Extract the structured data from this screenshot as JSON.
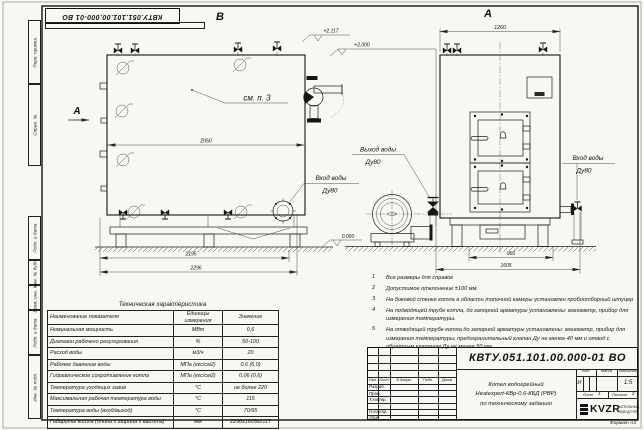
{
  "frame": {
    "stamp_top": "КВТУ.051.101.00.000-01 ВО",
    "format_note": "Формат  А3",
    "margin_top": [
      "Перв. примен.",
      "Справ. №"
    ],
    "margin_bottom": [
      "Подп. и дата",
      "Инв. № дубл.",
      "Взам. инв. №",
      "Подп. и дата",
      "Инв. № подл."
    ]
  },
  "views": {
    "view_b_label": "В",
    "view_a_label": "А",
    "section_a_label": "А",
    "callout_see_note": "см. п. 3",
    "dim_2050": "2050",
    "dim_2195": "2195",
    "dim_2296": "2296",
    "dim_1260": "1260",
    "dim_960": "960",
    "dim_1605": "1605",
    "elev_top": "+2.117",
    "elev_mid": "+2.000",
    "elev_zero": "0.000",
    "outlet_line1": "Выход воды",
    "outlet_line2": "Ду80",
    "inlet_b_line1": "Вход воды",
    "inlet_b_line2": "Ду80",
    "inlet_a_line1": "Вход воды",
    "inlet_a_line2": "Ду80"
  },
  "notes": {
    "items": [
      {
        "num": "1",
        "text": "Все размеры для справок"
      },
      {
        "num": "2",
        "text": "Допустимое отклонение ±100 мм."
      },
      {
        "num": "3",
        "text": "На боковой стенке котла в области топочной камеры установлен пробоотборный штуцер"
      },
      {
        "num": "4",
        "text": "На подводящей трубе котла, до запорной арматуры установлены: манометр, прибор для измерения температуры."
      },
      {
        "num": "5",
        "text": "На отводящей трубе котла до запорной арматуры установлены: манометр, прибор для измерения температуры, предохранительный клапан Ду не менее 40 мм и отвод с обратным клапаном Ду не менее 50 мм."
      }
    ]
  },
  "tech_table": {
    "title": "Техническая характеристика",
    "col_name": "Наименование показателя",
    "col_units": "Единицы измерения",
    "col_value": "Значение",
    "rows": [
      {
        "name": "Номинальная мощность",
        "units": "МВт",
        "value": "0,6"
      },
      {
        "name": "Диапазон рабочего регулирования",
        "units": "%",
        "value": "50-100"
      },
      {
        "name": "Расход воды",
        "units": "м3/ч",
        "value": "20"
      },
      {
        "name": "Рабочее давление воды",
        "units": "МПа (кгс/см2)",
        "value": "0,6 (6,0)"
      },
      {
        "name": "Гидравлическое сопротивление котла",
        "units": "МПа (кгс/см2)",
        "value": "0,06 (0,6)"
      },
      {
        "name": "Температура уходящих газов",
        "units": "°С",
        "value": "не более 220"
      },
      {
        "name": "Максимальная рабочая температура воды",
        "units": "°С",
        "value": "115"
      },
      {
        "name": "Температура воды (вход/выход)",
        "units": "°С",
        "value": "70/95"
      },
      {
        "name": "Габариты котла (длина х ширина х высота)",
        "units": "мм",
        "value": "2296х1605х2117"
      }
    ]
  },
  "title_block": {
    "doc_number": "КВТУ.051.101.00.000-01  ВО",
    "desc_line1": "Котел водогрейный",
    "desc_line2": "Heatexpert-КВр-0,6-КБД (РВР)",
    "desc_line3": "по техническому заданию",
    "col_izm": "Изм.",
    "col_list": "Лист",
    "col_doc": "N докум.",
    "col_sign": "Подп.",
    "col_date": "Дата",
    "row_razrab": "Разраб.",
    "row_prov": "Пров.",
    "row_tkontr": "Т.контр.",
    "row_nkontr": "Н.контр.",
    "row_utv": "Утв.",
    "lit_header": "Лит.",
    "mass_header": "Масса",
    "scale_header": "Масштаб",
    "lit_value": "И",
    "scale_value": "1:5",
    "sheet_label": "Лист",
    "sheet_value": "1",
    "sheets_label": "Листов",
    "sheets_value": "2",
    "logo": "KVZR",
    "logo_line1": "КОТЕЛЬНЫЙ",
    "logo_line2": "ЗАВОД РЭП"
  }
}
